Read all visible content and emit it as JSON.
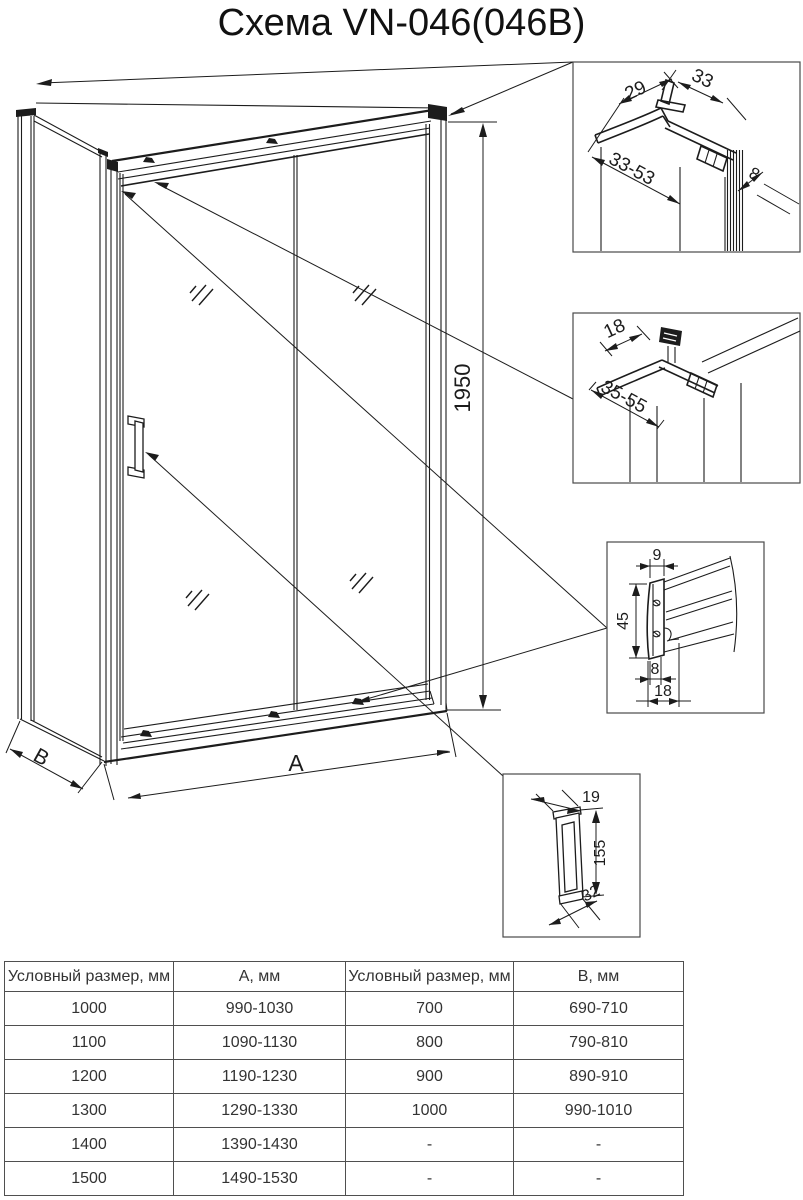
{
  "title": "Схема VN-046(046B)",
  "drawing": {
    "height": "1950",
    "width": "A",
    "depth": "B"
  },
  "details": {
    "wall_profile": {
      "d29": "29",
      "d33": "33",
      "range": "33-53",
      "d8": "8"
    },
    "top_rail": {
      "d18": "18",
      "range": "35-55"
    },
    "bottom_profile": {
      "d9": "9",
      "d45": "45",
      "d8": "8",
      "d18": "18"
    },
    "handle": {
      "d19": "19",
      "d155": "155",
      "d32": "32"
    }
  },
  "table": {
    "headers": [
      "Условный размер, мм",
      "А, мм",
      "Условный размер, мм",
      "В, мм"
    ],
    "rows": [
      [
        "1000",
        "990-1030",
        "700",
        "690-710"
      ],
      [
        "1100",
        "1090-1130",
        "800",
        "790-810"
      ],
      [
        "1200",
        "1190-1230",
        "900",
        "890-910"
      ],
      [
        "1300",
        "1290-1330",
        "1000",
        "990-1010"
      ],
      [
        "1400",
        "1390-1430",
        "-",
        "-"
      ],
      [
        "1500",
        "1490-1530",
        "-",
        "-"
      ]
    ]
  },
  "colors": {
    "line": "#1c1c1c",
    "box_border": "#4a4a4a",
    "table_border": "#4f4f4f"
  }
}
